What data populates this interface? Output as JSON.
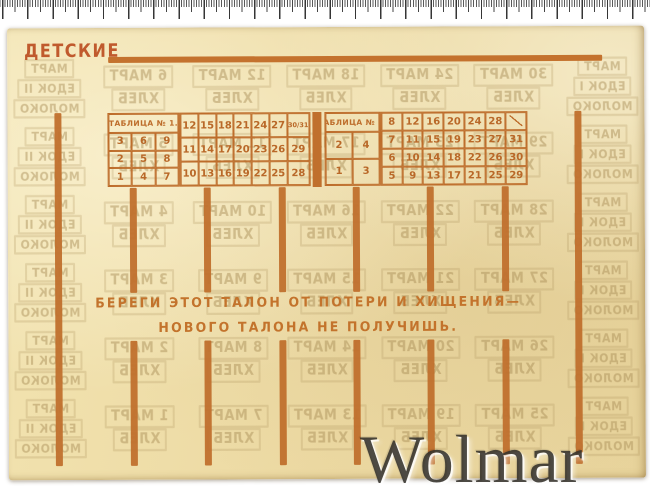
{
  "card": {
    "title": "ДЕТСКИЕ",
    "warning_line1": "БЕРЕГИ ЭТОТ ТАЛОН ОТ ПОТЕРИ И ХИЩЕНИЯ—",
    "warning_line2": "НОВОГО ТАЛОНА НЕ ПОЛУЧИШЬ.",
    "table1": {
      "header": "ТАБЛИЦА № 1.",
      "left_rows": [
        [
          "3",
          "6",
          "9"
        ],
        [
          "2",
          "5",
          "8"
        ],
        [
          "1",
          "4",
          "7"
        ]
      ],
      "right_rows": [
        [
          "12",
          "15",
          "18",
          "21",
          "24",
          "27",
          "30/31"
        ],
        [
          "11",
          "14",
          "17",
          "20",
          "23",
          "26",
          "29"
        ],
        [
          "10",
          "13",
          "16",
          "19",
          "22",
          "25",
          "28"
        ]
      ]
    },
    "table2": {
      "header": "ТАБЛИЦА № 2.",
      "left_rows": [
        [
          "2",
          "4"
        ],
        [
          "1",
          "3"
        ]
      ],
      "right_rows": [
        [
          "8",
          "12",
          "16",
          "20",
          "24",
          "28",
          "/"
        ],
        [
          "7",
          "11",
          "15",
          "19",
          "23",
          "27",
          "31"
        ],
        [
          "6",
          "10",
          "14",
          "18",
          "22",
          "26",
          "30"
        ],
        [
          "5",
          "9",
          "13",
          "17",
          "21",
          "25",
          "29"
        ]
      ]
    }
  },
  "watermark": {
    "stamp_month_word": "МАРТ",
    "stamp_product_word": "ХЛЕБ",
    "left_block_lines": [
      "МАРТ",
      "ЕДОК I",
      "МОЛОКО"
    ],
    "right_block_lines": [
      "МАРТ",
      "ЕДОК II",
      "МОЛОКО"
    ],
    "day_columns": [
      [
        30,
        29,
        28,
        27,
        26,
        25
      ],
      [
        24,
        23,
        22,
        21,
        20,
        19
      ],
      [
        18,
        17,
        16,
        15,
        14,
        13
      ],
      [
        12,
        11,
        10,
        9,
        8,
        7
      ],
      [
        6,
        5,
        4,
        3,
        2,
        1
      ]
    ]
  },
  "overlay": {
    "watermark_text": "Wolmar"
  },
  "colors": {
    "print_orange": "#c0702d",
    "table_ink": "#bd6c2a",
    "title_orange": "#c05a2d",
    "paper": "#ecd9a2",
    "bleed_tan": "#a78c56",
    "wolmar_gray": "#34312a",
    "ruler_tick": "#353535"
  }
}
